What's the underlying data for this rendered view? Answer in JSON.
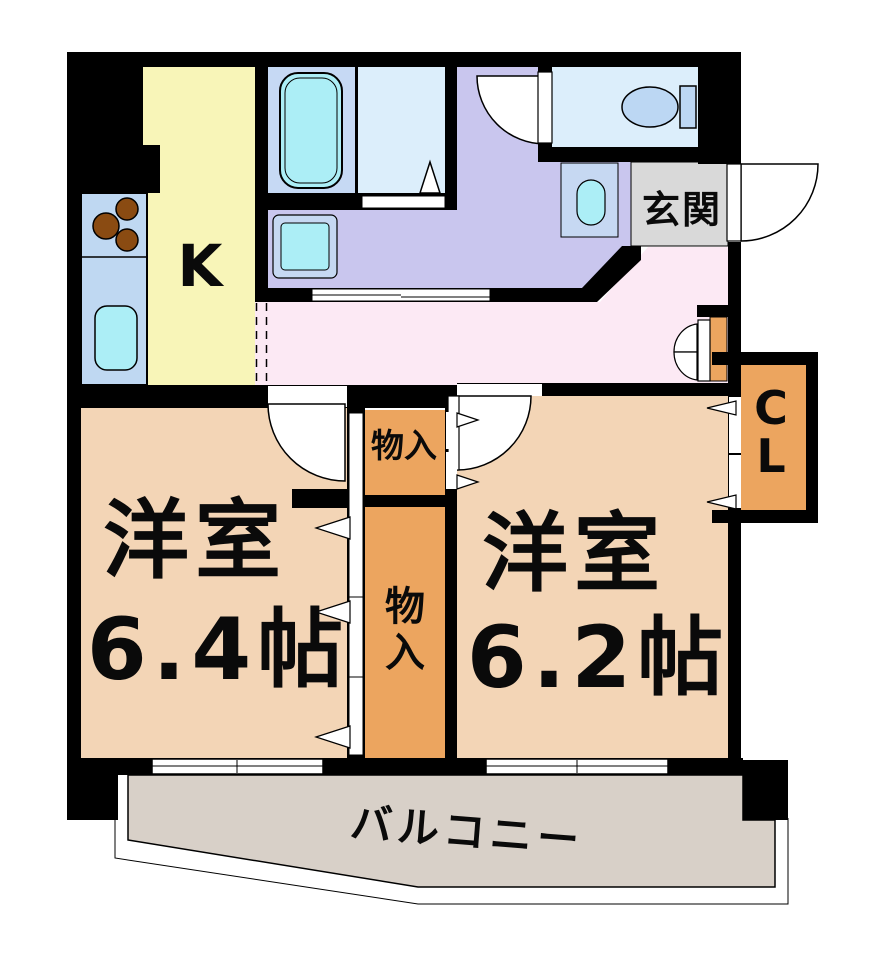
{
  "floorplan": {
    "labels": {
      "kitchen": "K",
      "entrance": "玄関",
      "storage_top": "物入",
      "storage_tall_chars": [
        "物",
        "入"
      ],
      "closet_chars": [
        "C",
        "L"
      ],
      "room_left_name": "洋室",
      "room_left_size": "6.4帖",
      "room_right_name": "洋室",
      "room_right_size": "6.2帖",
      "balcony": "バルコニー"
    },
    "colors": {
      "wall": "#000000",
      "opening": "#ffffff",
      "kitchen_floor": "#f8f5b8",
      "counter": "#bfd8f2",
      "fixture_cyan": "#aceef6",
      "stove_burner": "#8a4b12",
      "bath_floor": "#c6d9f4",
      "shower_floor": "#dceefb",
      "washroom_floor": "#c9c6ee",
      "toilet_floor": "#dceefb",
      "toilet_fixture": "#bcd7f3",
      "pan_outer": "#c6d8f2",
      "entrance_floor": "#d9d9d9",
      "hallway_floor": "#fce9f4",
      "room_floor": "#f3d5b6",
      "storage": "#eca55f",
      "balcony_floor": "#d8d0c8"
    }
  }
}
